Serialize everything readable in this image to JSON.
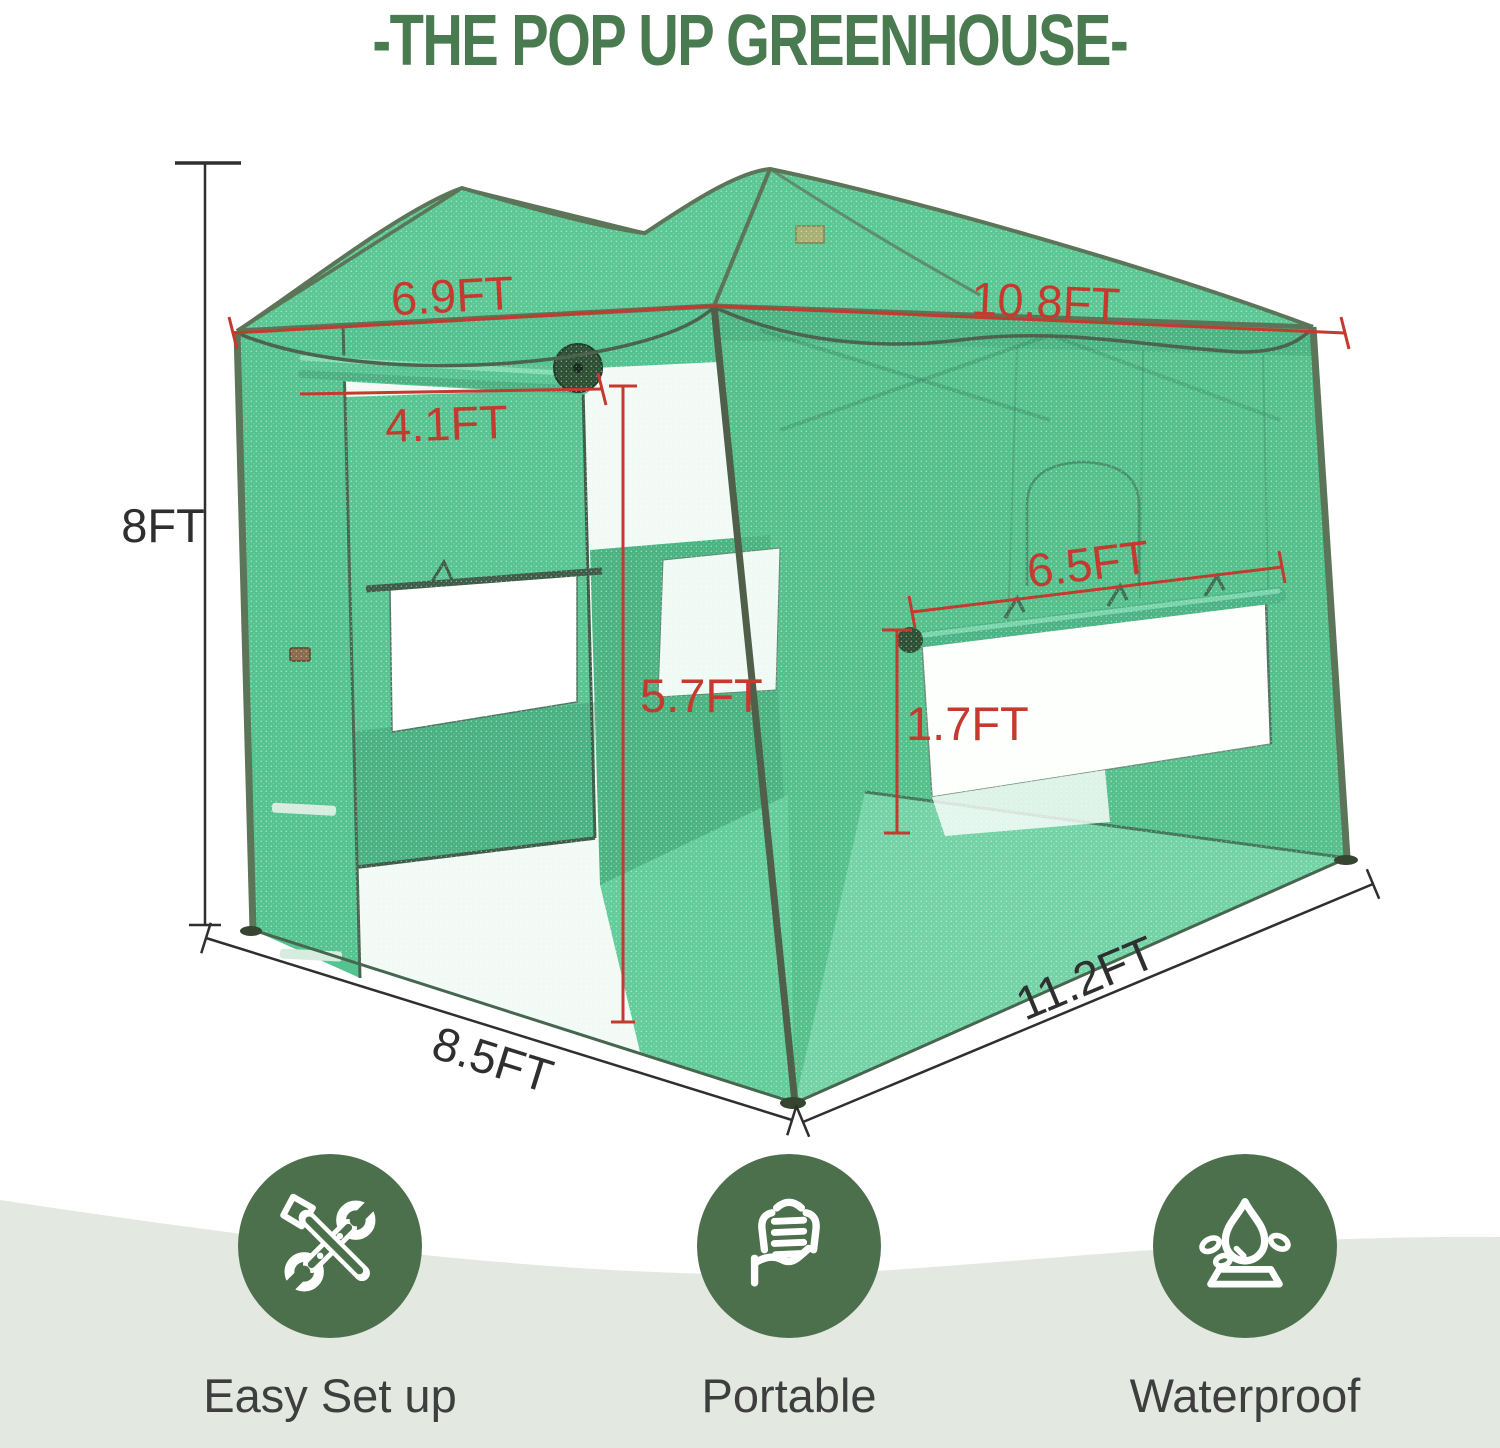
{
  "title": "-THE POP UP GREENHOUSE-",
  "dimensions": {
    "roof_front_width": "6.9FT",
    "roof_side_length": "10.8FT",
    "door_width": "4.1FT",
    "height": "8FT",
    "door_height": "5.7FT",
    "side_window_width": "6.5FT",
    "side_window_height": "1.7FT",
    "base_depth": "8.5FT",
    "base_length": "11.2FT"
  },
  "features": [
    {
      "label": "Easy Set up",
      "icon": "tools-icon"
    },
    {
      "label": "Portable",
      "icon": "portable-hand-icon"
    },
    {
      "label": "Waterproof",
      "icon": "waterproof-icon"
    }
  ],
  "colors": {
    "title_green": "#4a7a50",
    "dimension_red": "#c43a2e",
    "dimension_black": "#2f2f2f",
    "mesh_green": "#58c591",
    "frame_olive": "#5c7458",
    "icon_circle_green": "#4c6f4c",
    "band_gray_green": "#e3e8e1",
    "feature_label_color": "#3e3e3e"
  }
}
